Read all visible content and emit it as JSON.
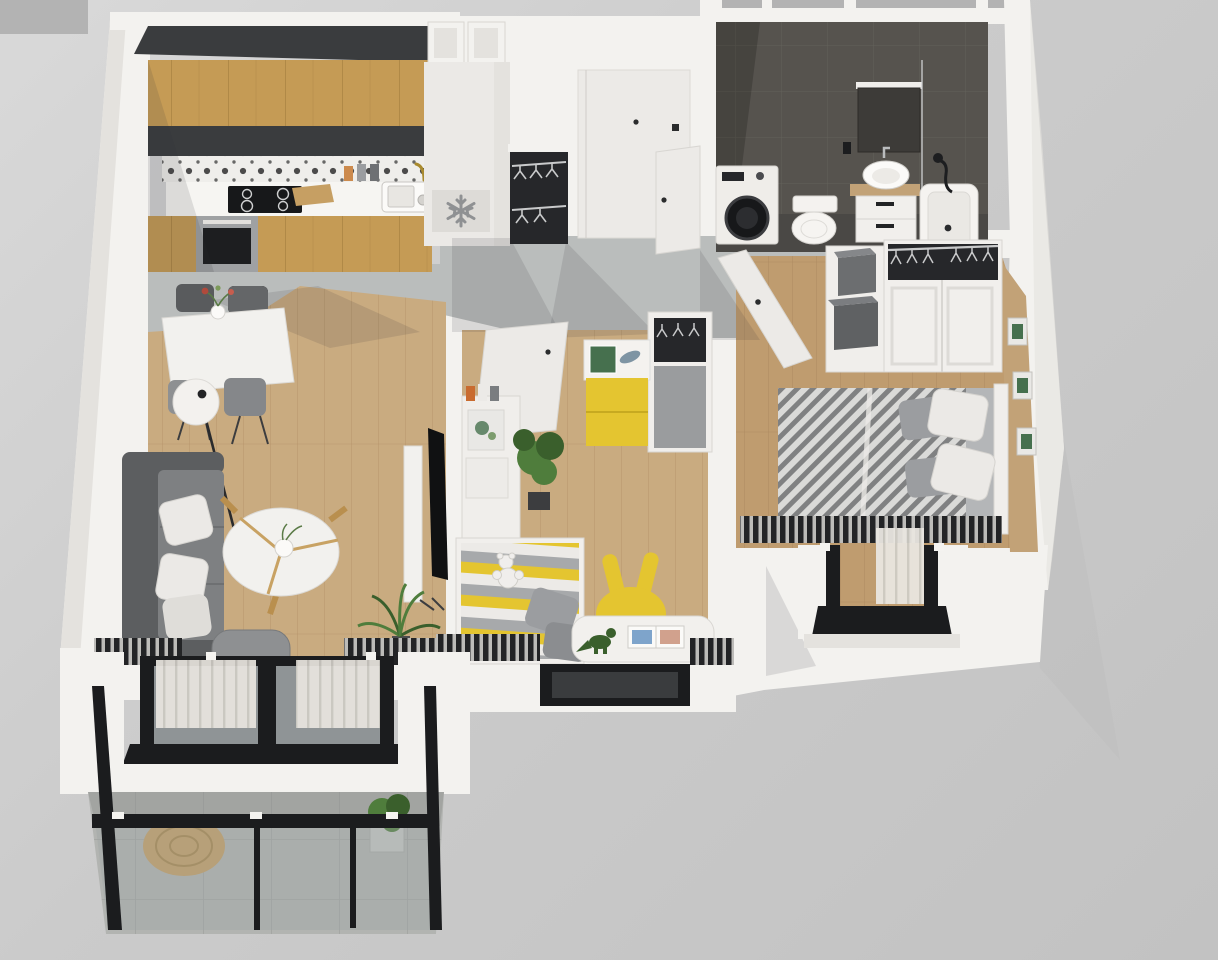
{
  "scene": {
    "title": "3D apartment floor plan render, top-down axonometric view",
    "rooms": [
      {
        "name": "kitchen",
        "furniture": [
          "upper oak cabinets",
          "dark soffit",
          "patterned tile backsplash",
          "white countertop",
          "induction hob",
          "oven",
          "sink with brass faucet",
          "cutting board",
          "spice jars",
          "tall fridge with snowflake badge"
        ]
      },
      {
        "name": "entry-hall",
        "furniture": [
          "entry door with peephole and black handle",
          "open hall wardrobe with hangers",
          "grey concrete floor"
        ]
      },
      {
        "name": "bathroom",
        "furniture": [
          "dark grey wall tiles",
          "washing machine",
          "toilet",
          "vanity with vessel sink and wood top",
          "mirror",
          "bathtub with black shower set"
        ]
      },
      {
        "name": "corridor",
        "furniture": [
          "open bathroom door",
          "open bedroom door"
        ]
      },
      {
        "name": "bedroom",
        "furniture": [
          "double bed with herringbone blanket",
          "grey and white pillows",
          "white wardrobe with open hanger top",
          "shelf unit with grey boxes",
          "radiator",
          "french balcony window",
          "wood feature wall with three framed prints"
        ]
      },
      {
        "name": "kids-room",
        "furniture": [
          "open door",
          "yellow dresser with book and fish toy",
          "open closet with hangers",
          "white bookshelf",
          "potted plant",
          "striped toddler bed with teddy",
          "grey pillows",
          "yellow bunny-ear chair",
          "white play table with dinosaur and picture book",
          "window"
        ]
      },
      {
        "name": "living-room",
        "furniture": [
          "white dining table with flower vase",
          "four grey chairs",
          "white globe floor lamp",
          "grey sofa with white cushions",
          "round white coffee table with wood legs",
          "tv on media panel",
          "boucle armchair",
          "palm plant",
          "sliding glass door with sheer curtains",
          "radiators"
        ]
      },
      {
        "name": "balcony",
        "furniture": [
          "glass railing with black frame",
          "concrete tile floor",
          "round jute rug",
          "potted plant"
        ]
      }
    ]
  },
  "icons": {
    "fridge_badge": "snowflake"
  },
  "colors": {
    "bg_corner": "#b3b3b3",
    "wall": "#f3f2ef",
    "wall_shade": "#e4e2de",
    "wall_edge": "#d7d5d1",
    "concrete": "#babdbc",
    "wood": "#c9ab80",
    "wood_line": "#b08e63",
    "wood_bed": "#bf9c6f",
    "wood_bed_line": "#a5825a",
    "oak": "#c59b55",
    "oak_line": "#9f7a3c",
    "soffit": "#3a3c3e",
    "splash_bg": "#efeeeb",
    "splash_ink": "#2f2f2f",
    "counter": "#f6f5f2",
    "cooktop": "#17181a",
    "steel": "#9fa1a3",
    "oven_glass": "#1d1e20",
    "fridge": "#ebe9e6",
    "badge": "#dddbd7",
    "snow": "#8f9193",
    "door": "#eceae7",
    "door_shade": "#cfccc8",
    "hardware": "#2b2c2d",
    "wdark": "#26272a",
    "hanger": "#c9cacb",
    "bath_wall": "#56534e",
    "bath_line": "#67645c",
    "bath_floor": "#4a4845",
    "white_goods": "#efede9",
    "yellow": "#e4c530",
    "sofa_dark": "#5c5e60",
    "sofa_mid": "#7e8082",
    "pillow": "#ebe9e6",
    "pillow_grey": "#9b9da0",
    "table": "#f2f1ee",
    "blanket": "#dadad8",
    "blanket_ink": "#45464a",
    "rad_base": "#232426",
    "rad_fin": "#d8d7d3",
    "tan_wall": "#c2a277",
    "frame": "#e9e8e5",
    "art": "#46704e",
    "green": "#4f7d3c",
    "green_dark": "#3a5f2c",
    "glass": "#8f9496",
    "rail": "#1b1c1e",
    "curtain": "#e9e6e0",
    "curtain_line": "#cfccc5",
    "balcony": "#b2b4b1",
    "balcony_line": "#9da09d",
    "rug": "#c69f63",
    "rug_line": "#aa8448",
    "shadow": "rgba(50,50,55,0.13)"
  }
}
